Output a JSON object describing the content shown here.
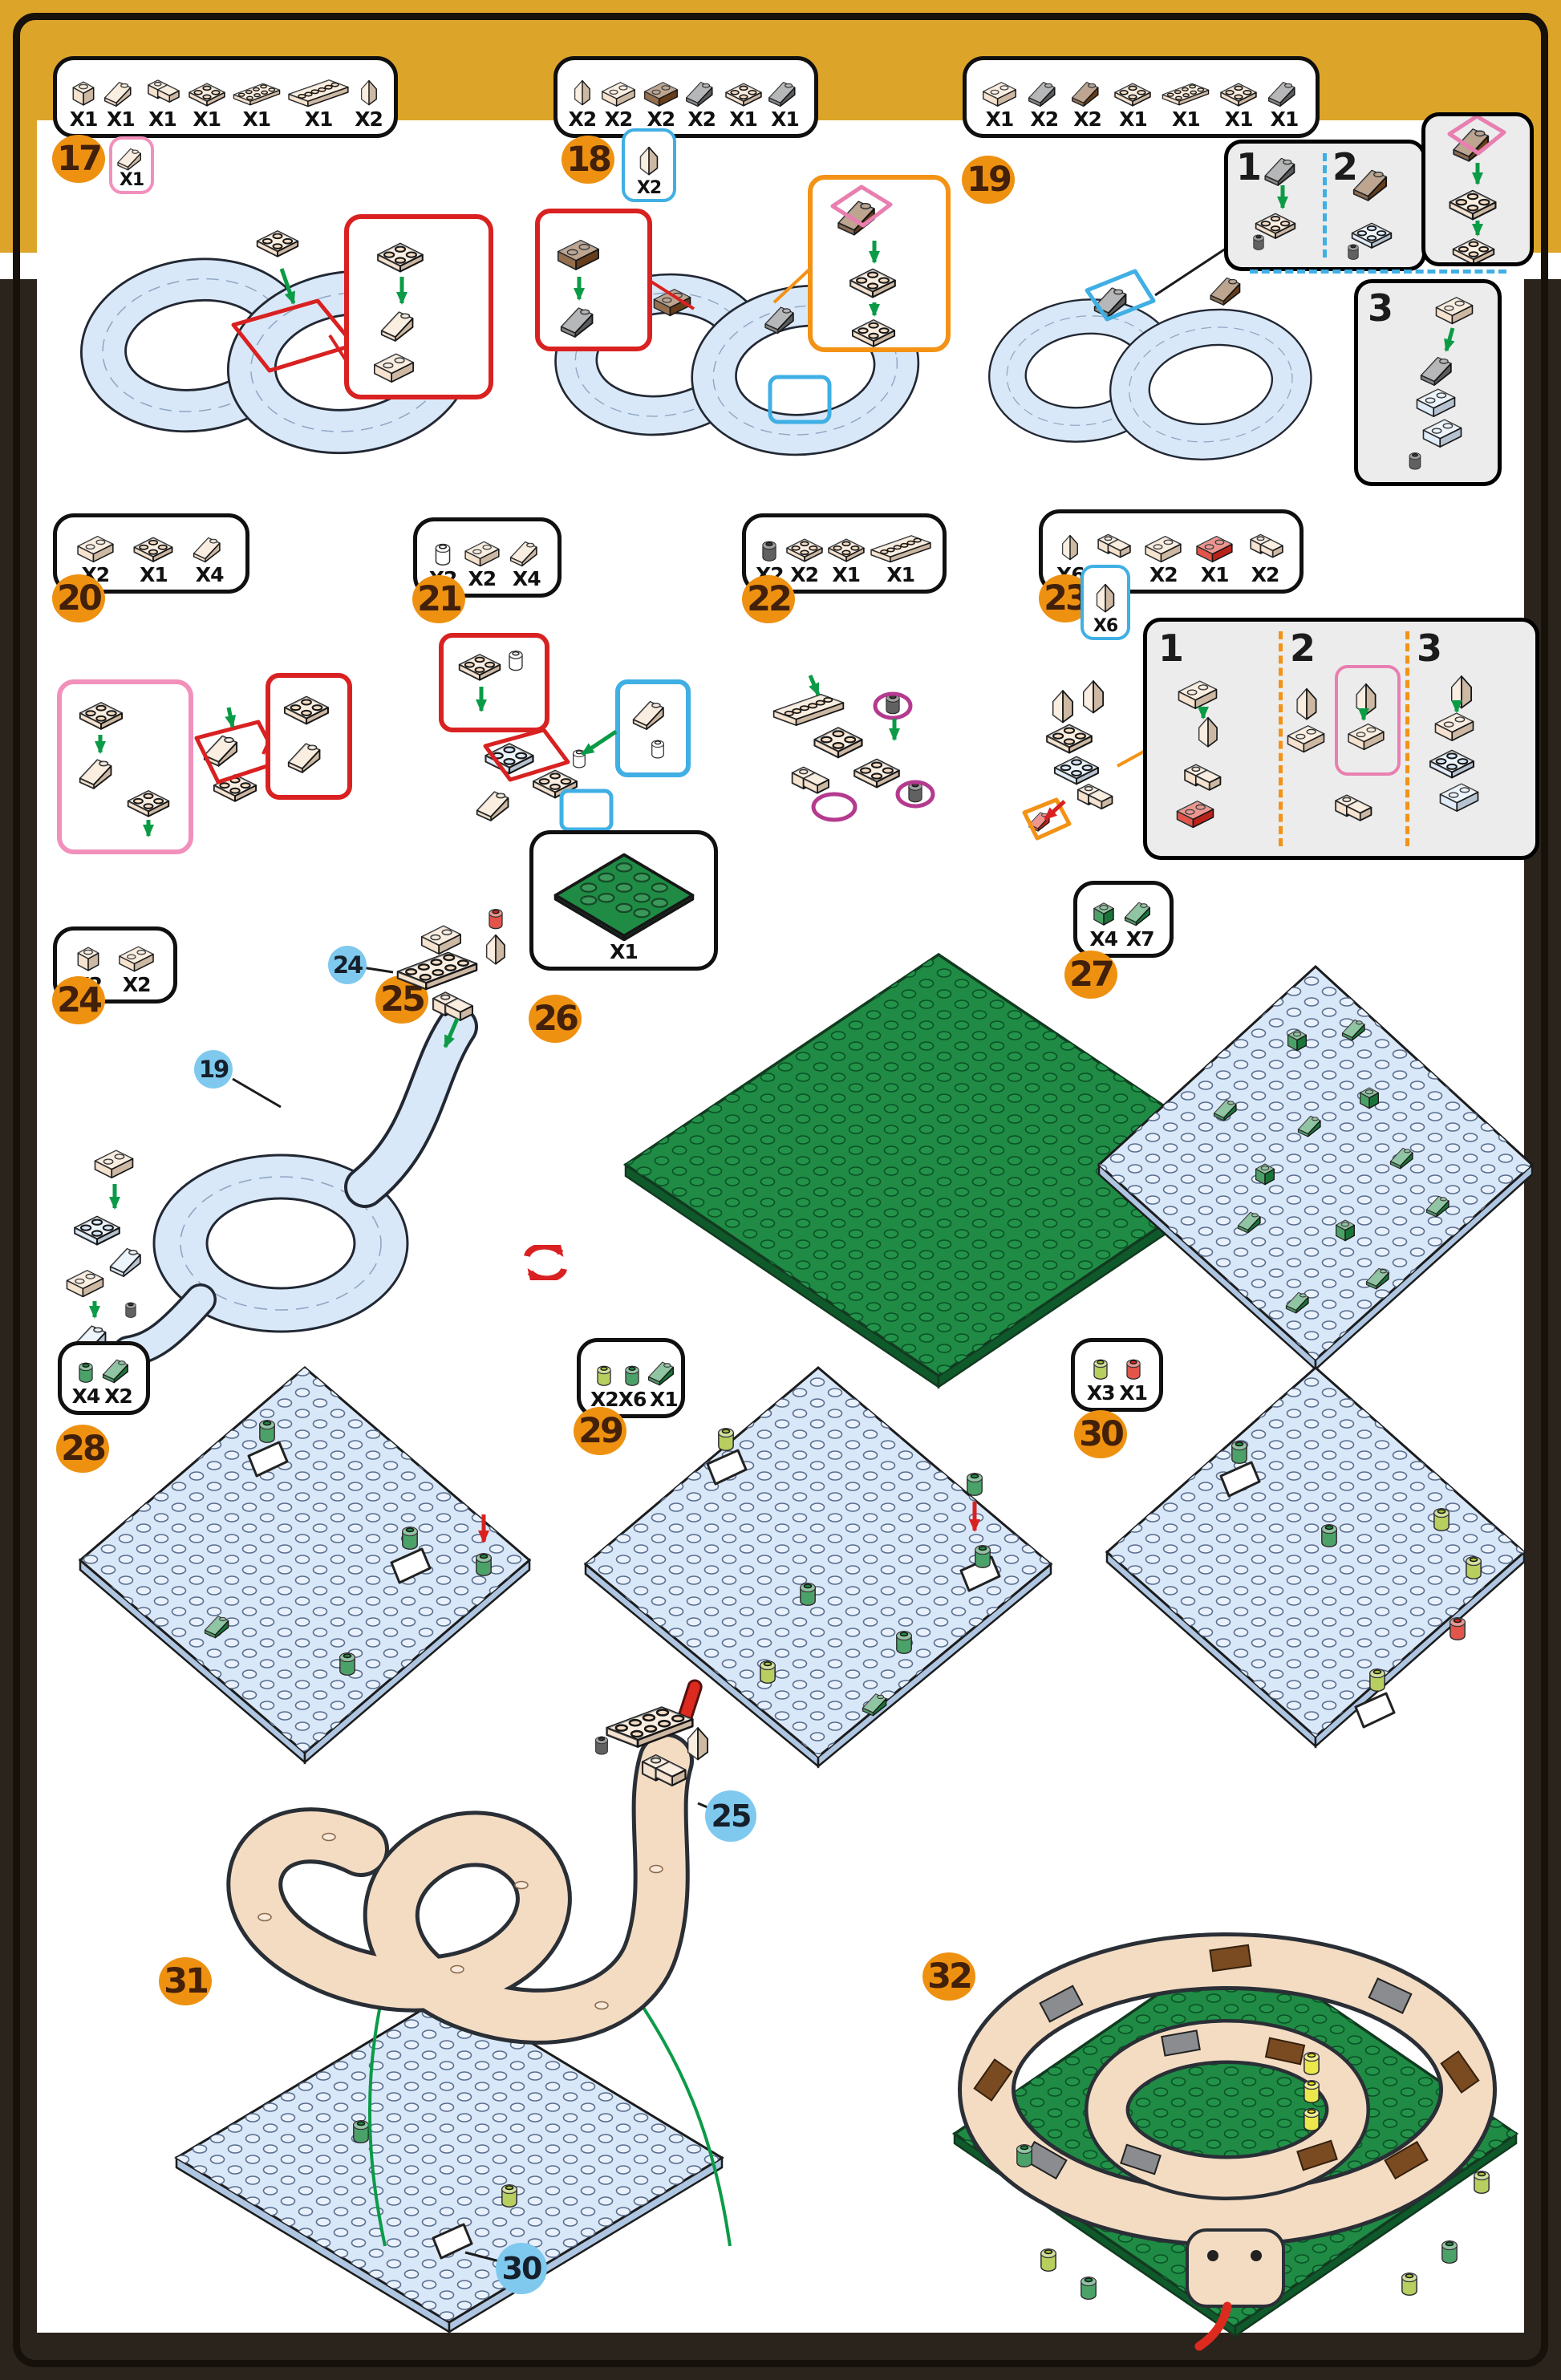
{
  "colors": {
    "gold_band": "#DDA42A",
    "edge_dark": "#2B241C",
    "badge_orange": "#EE9111",
    "badge_text": "#42200A",
    "callout_circle_blue": "#7FC9EF",
    "outline_red": "#D92121",
    "outline_blue": "#3FAFE4",
    "outline_orange": "#F39215",
    "outline_pink": "#F290BC",
    "outline_magenta": "#B53A8F",
    "brick_tan": "#F4DCC3",
    "brick_brown": "#7A4A21",
    "brick_gray": "#6D6E71",
    "brick_pale_blue": "#D9E8F8",
    "brick_green": "#1F8B44",
    "brick_lime": "#A6C437",
    "brick_red": "#DD2A1F",
    "brick_yellow": "#E8E21F",
    "arrow_green": "#0B9B47",
    "rotate_icon_red": "#D92121"
  },
  "steps": {
    "s17": {
      "badge": "17",
      "parts": [
        {
          "icon": "tan-brick-1x1",
          "count": "X1"
        },
        {
          "icon": "tan-slope-1x2",
          "count": "X1"
        },
        {
          "icon": "tan-corner-plate",
          "count": "X1"
        },
        {
          "icon": "tan-slope-2x2",
          "count": "X1"
        },
        {
          "icon": "tan-plate-2x4",
          "count": "X1"
        },
        {
          "icon": "tan-plate-2x6",
          "count": "X1"
        },
        {
          "icon": "tan-slope-1x1-tall",
          "count": "X2"
        }
      ],
      "extra": {
        "icon": "tan-slope-1x2",
        "count": "X1"
      }
    },
    "s18": {
      "badge": "18",
      "parts": [
        {
          "icon": "tan-wedge",
          "count": "X2"
        },
        {
          "icon": "tan-brick-1x2",
          "count": "X2"
        },
        {
          "icon": "brown-brick-1x2",
          "count": "X2"
        },
        {
          "icon": "gray-slope-1x2",
          "count": "X2"
        },
        {
          "icon": "tan-plate-2x2",
          "count": "X1"
        },
        {
          "icon": "gray-slope-2x2",
          "count": "X1"
        }
      ],
      "extra": {
        "icon": "tan-wedge",
        "count": "X2"
      }
    },
    "s19": {
      "badge": "19",
      "parts": [
        {
          "icon": "tan-brick-1x2",
          "count": "X1"
        },
        {
          "icon": "gray-slope-1x2",
          "count": "X2"
        },
        {
          "icon": "brown-slope-1x2",
          "count": "X2"
        },
        {
          "icon": "tan-plate-2x2",
          "count": "X1"
        },
        {
          "icon": "tan-plate-2x4",
          "count": "X1"
        },
        {
          "icon": "tan-slope-2x2",
          "count": "X1"
        },
        {
          "icon": "gray-slope-2x2",
          "count": "X1"
        }
      ],
      "substeps": [
        "1",
        "2",
        "3"
      ]
    },
    "s20": {
      "badge": "20",
      "parts": [
        {
          "icon": "tan-plate-1x3-rounded",
          "count": "X2"
        },
        {
          "icon": "tan-plate-2x3-ball",
          "count": "X1"
        },
        {
          "icon": "tan-wedge-plate-2x2",
          "count": "X4"
        }
      ]
    },
    "s21": {
      "badge": "21",
      "parts": [
        {
          "icon": "white-round-1x1",
          "count": "X2"
        },
        {
          "icon": "tan-plate-1x3-clip",
          "count": "X2"
        },
        {
          "icon": "tan-wedge-plate-2x2",
          "count": "X4"
        }
      ]
    },
    "s22": {
      "badge": "22",
      "parts": [
        {
          "icon": "black-round-1x1",
          "count": "X2"
        },
        {
          "icon": "tan-plate-2x3",
          "count": "X2"
        },
        {
          "icon": "tan-plate-2x2-studs",
          "count": "X1"
        },
        {
          "icon": "tan-plate-1x6",
          "count": "X1"
        }
      ]
    },
    "s23": {
      "badge": "23",
      "parts": [
        {
          "icon": "tan-wedge",
          "count": "X6"
        },
        {
          "icon": "tan-corner-brick",
          "count": "X4"
        },
        {
          "icon": "tan-plate-1x3",
          "count": "X2"
        },
        {
          "icon": "red-plate-1x3-curved",
          "count": "X1"
        },
        {
          "icon": "tan-plate-wall",
          "count": "X2"
        }
      ],
      "extra": {
        "icon": "tan-wedge",
        "count": "X6"
      },
      "substeps": [
        "1",
        "2",
        "3"
      ]
    },
    "s24": {
      "badge": "24",
      "parts": [
        {
          "icon": "tan-brick-1x1",
          "count": "X2"
        },
        {
          "icon": "tan-brick-1x2",
          "count": "X2"
        }
      ]
    },
    "s25": {
      "badge": "25",
      "refs": {
        "head": "24",
        "body": "19"
      },
      "rotate_icon": "rotate-arrows"
    },
    "s26": {
      "badge": "26",
      "parts": [
        {
          "icon": "green-baseplate-16x16",
          "count": "X1"
        }
      ]
    },
    "s27": {
      "badge": "27",
      "parts": [
        {
          "icon": "green-brick-1x1",
          "count": "X4"
        },
        {
          "icon": "green-slope-plant",
          "count": "X7"
        }
      ]
    },
    "s28": {
      "badge": "28",
      "parts": [
        {
          "icon": "green-round-1x1",
          "count": "X4"
        },
        {
          "icon": "green-slope-plant",
          "count": "X2"
        }
      ]
    },
    "s29": {
      "badge": "29",
      "parts": [
        {
          "icon": "lime-round-1x1",
          "count": "X2"
        },
        {
          "icon": "green-round-1x1",
          "count": "X6"
        },
        {
          "icon": "green-plant-tall",
          "count": "X1"
        }
      ]
    },
    "s30": {
      "badge": "30",
      "parts": [
        {
          "icon": "lime-round-1x1",
          "count": "X3"
        },
        {
          "icon": "red-round-1x1",
          "count": "X1"
        }
      ]
    },
    "s31": {
      "badge": "31",
      "refs": {
        "head": "25",
        "plate": "30"
      }
    },
    "s32": {
      "badge": "32"
    }
  }
}
